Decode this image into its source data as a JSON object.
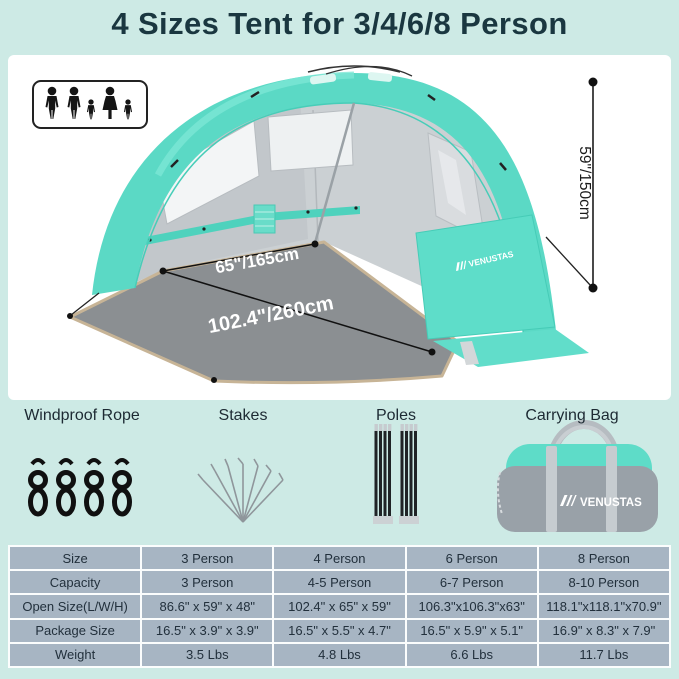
{
  "title": "4 Sizes Tent for 3/4/6/8 Person",
  "colors": {
    "background_mint": "#cdeae5",
    "tent_teal": "#5bd9c5",
    "table_cell": "#a7b5c3",
    "title_text": "#1a3740",
    "floor_gray": "#8b8f92"
  },
  "hero": {
    "family_icon": "family-capacity-icon",
    "brand": "VENUSTAS",
    "dims": {
      "height": "59\"/150cm",
      "width": "65\"/165cm",
      "depth": "102.4\"/260cm"
    }
  },
  "accessories": {
    "items": [
      {
        "label": "Windproof Rope",
        "icon": "windproof-rope-icon"
      },
      {
        "label": "Stakes",
        "icon": "stakes-icon"
      },
      {
        "label": "Poles",
        "icon": "poles-icon"
      },
      {
        "label": "Carrying Bag",
        "icon": "carrying-bag-icon"
      }
    ]
  },
  "spec_table": {
    "columns": [
      "Size",
      "3 Person",
      "4 Person",
      "6 Person",
      "8 Person"
    ],
    "rows": [
      [
        "Capacity",
        "3 Person",
        "4-5 Person",
        "6-7 Person",
        "8-10 Person"
      ],
      [
        "Open Size(L/W/H)",
        "86.6\" x 59\" x 48\"",
        "102.4\" x 65\" x 59\"",
        "106.3\"x106.3\"x63\"",
        "118.1\"x118.1\"x70.9\""
      ],
      [
        "Package Size",
        "16.5\" x 3.9\" x 3.9\"",
        "16.5\" x 5.5\" x 4.7\"",
        "16.5\" x 5.9\" x 5.1\"",
        "16.9\" x 8.3\" x 7.9\""
      ],
      [
        "Weight",
        "3.5 Lbs",
        "4.8 Lbs",
        "6.6 Lbs",
        "11.7 Lbs"
      ]
    ]
  }
}
